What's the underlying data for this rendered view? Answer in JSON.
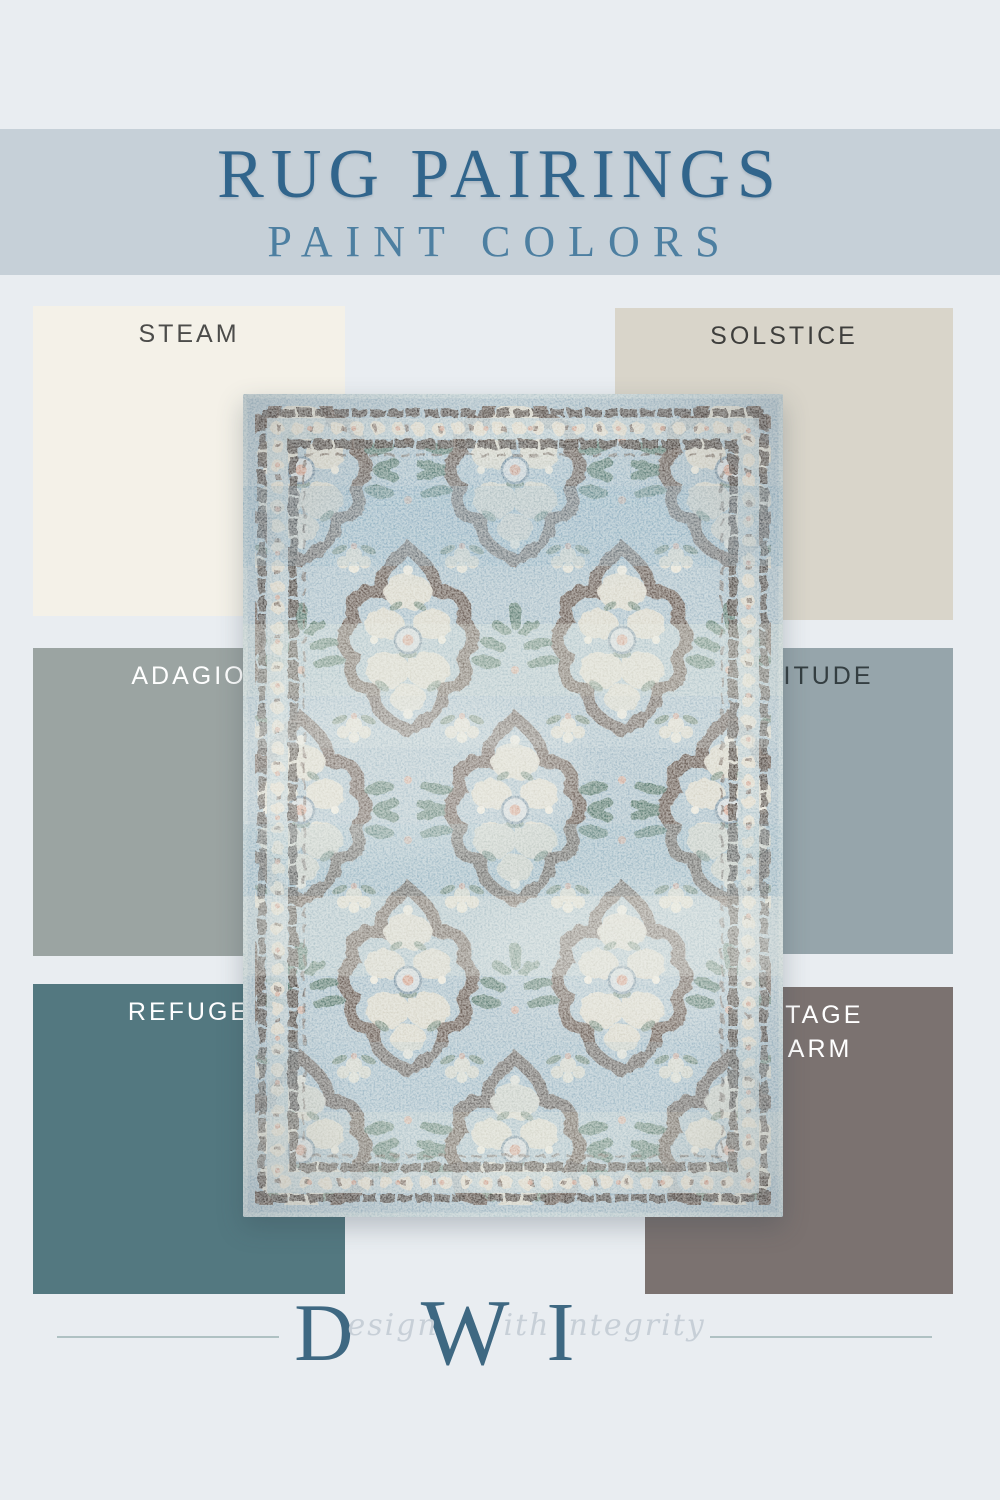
{
  "page": {
    "background": "#e9edf1"
  },
  "header": {
    "title": "RUG PAIRINGS",
    "subtitle": "PAINT COLORS",
    "band_color": "#c6d0d8",
    "title_color": "#31658c",
    "subtitle_color": "#4d7fa1"
  },
  "swatches": {
    "steam": {
      "label": "STEAM",
      "color": "#f4f1e8",
      "label_color": "#4c4c4a"
    },
    "solstice": {
      "label": "SOLSTICE",
      "color": "#d9d5ca",
      "label_color": "#3e3e3c"
    },
    "adagio": {
      "label": "ADAGIO",
      "color": "#9ba4a2",
      "label_color": "#ffffff"
    },
    "solitude": {
      "label": "SOLITUDE",
      "color": "#96a5ab",
      "label_color": "#343e41"
    },
    "refuge": {
      "label": "REFUGE",
      "color": "#537880",
      "label_color": "#ffffff"
    },
    "vintage_charm": {
      "label_line1": "VINTAGE",
      "label_line2": "CHARM",
      "color": "#7b7270",
      "label_color": "#ffffff"
    }
  },
  "rug": {
    "description": "vintage light-blue floral quatrefoil medallion area rug",
    "palette": {
      "field_blue": "#a7bdc9",
      "band_light": "#d8dfd8",
      "wreath_brown": "#5d4c43",
      "floral_cream": "#dbd7c9",
      "leaf_green": "#4e6f63",
      "accent_pink": "#d2a492"
    }
  },
  "footer": {
    "logo": {
      "initial_d": "D",
      "script_esign": "esign",
      "initial_w": "W",
      "script_ith": "ith",
      "initial_i": "I",
      "script_ntegrity": "ntegrity"
    },
    "rule_color": "#afc1c3"
  }
}
